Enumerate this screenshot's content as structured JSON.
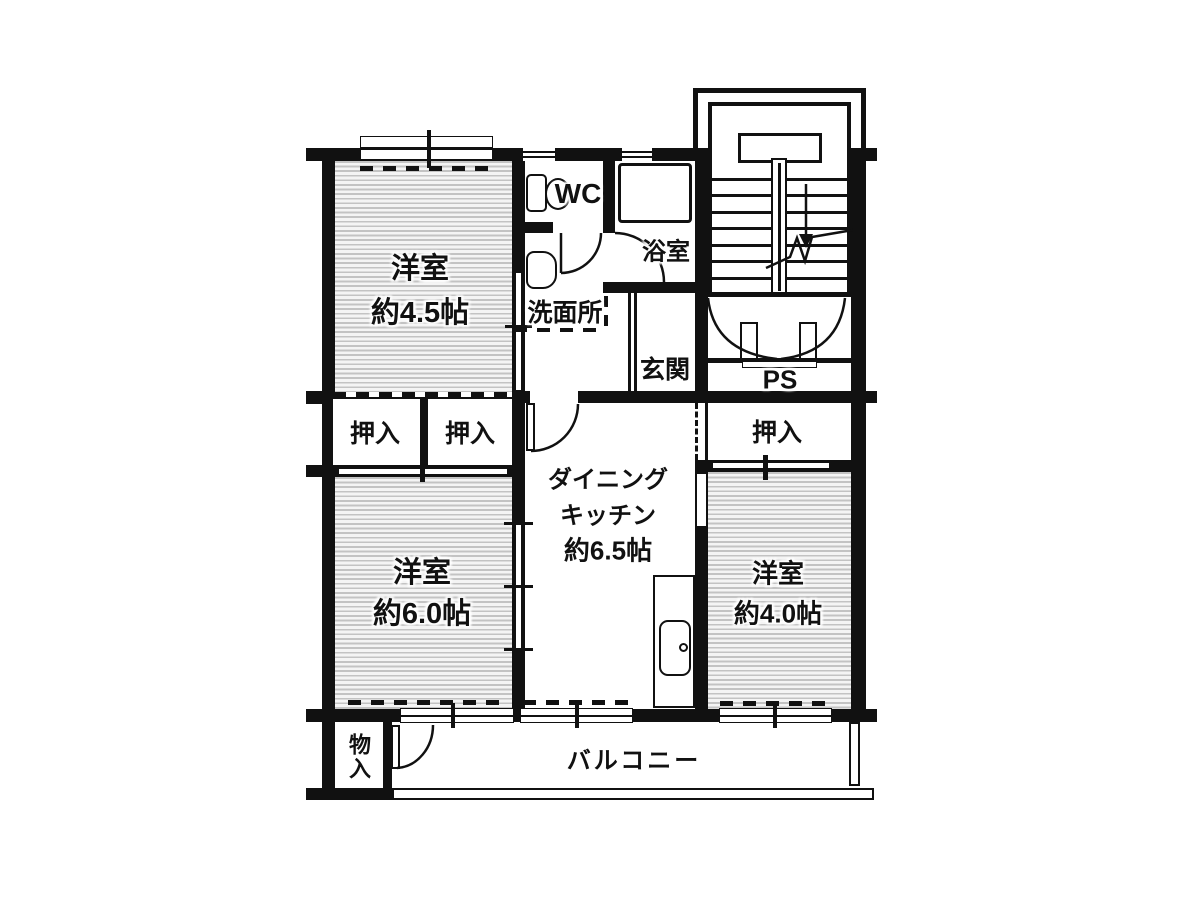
{
  "rooms": {
    "bedroom_45": {
      "name": "洋室",
      "size": "約4.5帖"
    },
    "bedroom_60": {
      "name": "洋室",
      "size": "約6.0帖"
    },
    "bedroom_40": {
      "name": "洋室",
      "size": "約4.0帖"
    },
    "dining_kitchen": {
      "name_line1": "ダイニング",
      "name_line2": "キッチン",
      "size": "約6.5帖"
    },
    "wc": {
      "name": "WC"
    },
    "bath": {
      "name": "浴室"
    },
    "washroom": {
      "name": "洗面所"
    },
    "entrance": {
      "name": "玄関"
    },
    "pipe_space": {
      "name": "PS"
    },
    "closet_left": {
      "name": "押入"
    },
    "closet_center": {
      "name": "押入"
    },
    "closet_right": {
      "name": "押入"
    },
    "storage": {
      "name": "物入"
    },
    "balcony": {
      "name": "バルコニー"
    }
  },
  "colors": {
    "wall": "#111111",
    "background": "#ffffff",
    "tatami_stripe": "#c3c3c3"
  }
}
